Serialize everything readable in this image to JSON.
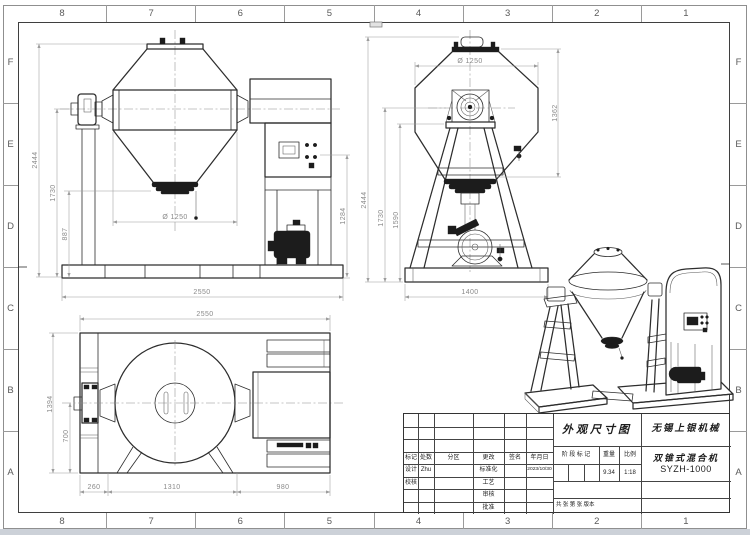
{
  "grid": {
    "cols": [
      "8",
      "7",
      "6",
      "5",
      "4",
      "3",
      "2",
      "1"
    ],
    "rows": [
      "F",
      "E",
      "D",
      "C",
      "B",
      "A"
    ]
  },
  "views": {
    "front": {
      "dim_total_height": "2444",
      "dim_axis_height": "1730",
      "dim_discharge_height": "887",
      "dim_diameter": "Ø 1250",
      "dim_panel_height": "1284",
      "dim_base_width": "2550"
    },
    "side": {
      "dim_diameter": "Ø 1250",
      "dim_cone_height": "1362",
      "dim_total_height": "2444",
      "dim_axis_height": "1730",
      "dim_frame_height": "1590",
      "dim_base_width": "1400"
    },
    "plan": {
      "dim_width": "2550",
      "dim_depth": "1394",
      "dim_axis_depth": "700",
      "dim_left_offset": "260",
      "dim_center_span": "1310",
      "dim_right_span": "980"
    }
  },
  "title_block": {
    "doc_title": "外观尺寸图",
    "company": "无锡上银机械",
    "product": "双锥式混合机",
    "model": "SYZH-1000",
    "col_mark": "标记",
    "col_count": "处数",
    "col_zone": "分区",
    "col_change": "更改",
    "col_sign": "签名",
    "col_date": "年月日",
    "row_design": "设计",
    "designer": "Zhu",
    "row_check": "校核",
    "row_standard": "标准化",
    "row_process": "工艺",
    "row_review": "审核",
    "row_approve": "批准",
    "date": "2023/10/30",
    "stage_label": "阶 段 标 记",
    "weight_label": "重量",
    "scale_label": "比例",
    "weight": "9.34",
    "scale": "1:18",
    "sheet_info": "共 张 第 张 版本"
  }
}
